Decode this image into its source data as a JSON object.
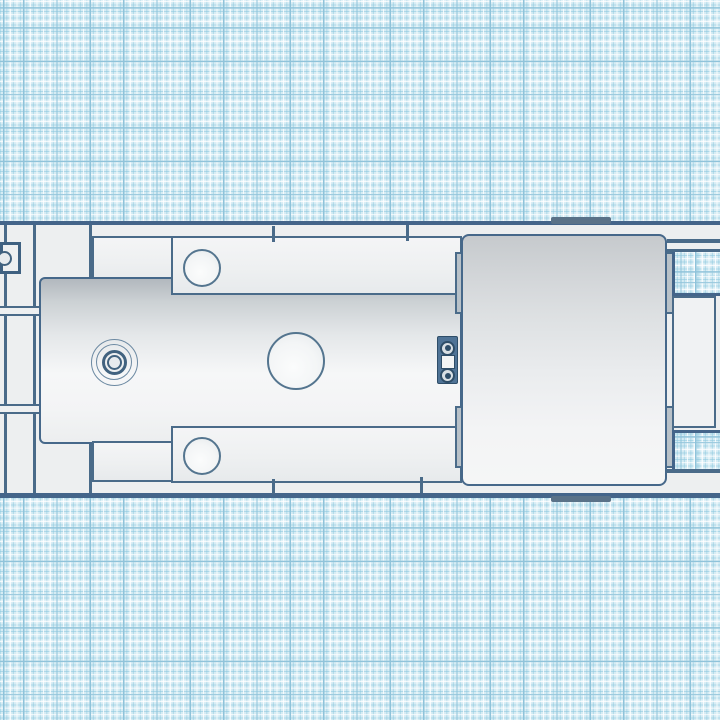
{
  "app": {
    "view": "3d-design-workplane-top-view"
  },
  "colors": {
    "grid_background": "#d6ecf4",
    "grid_major_line": "#8fc3da",
    "grid_minor_blue": "#8cc8de",
    "grid_minor_white": "#ffffff",
    "outline_ink": "#44658a",
    "deck_fill": "#edeff0",
    "panel_fill": "#f0f2f3",
    "body_top_shade": "#b2b8be",
    "cab_top_shade": "#c6cacd",
    "coupler_plate": "#4f7396",
    "ear_fill": "#b8c1c8",
    "tab_fill": "#5a7288"
  },
  "workplane": {
    "grid_major_px": 33.333,
    "grid_minor_px": 6.667,
    "grid_offset_x": 23,
    "grid_offset_y": 8.67
  },
  "scene": {
    "parts": [
      {
        "name": "deck-base",
        "type": "rect",
        "cls": "deck",
        "x": 0,
        "y": 221,
        "w": 720,
        "h": 277,
        "interactable": true
      },
      {
        "name": "deck-top-edge",
        "type": "rect",
        "cls": "ink",
        "x": 0,
        "y": 221,
        "w": 720,
        "h": 4,
        "interactable": false
      },
      {
        "name": "deck-bottom-edge",
        "type": "rect",
        "cls": "ink",
        "x": 0,
        "y": 493,
        "w": 720,
        "h": 5,
        "interactable": false
      },
      {
        "name": "left-seam-line",
        "type": "rect",
        "cls": "ink-thin",
        "x": 4,
        "y": 225,
        "w": 2.5,
        "h": 268,
        "interactable": false
      },
      {
        "name": "left-column-line",
        "type": "rect",
        "cls": "ink-thin",
        "x": 33,
        "y": 225,
        "w": 3,
        "h": 268,
        "interactable": false
      },
      {
        "name": "left-crossbar-upper",
        "type": "rect",
        "cls": "strip",
        "x": 0,
        "y": 306,
        "w": 41,
        "h": 10,
        "interactable": true
      },
      {
        "name": "left-crossbar-lower",
        "type": "rect",
        "cls": "strip",
        "x": 0,
        "y": 404,
        "w": 41,
        "h": 10,
        "interactable": true
      },
      {
        "name": "front-post-line-top",
        "type": "rect",
        "cls": "ink-thin",
        "x": 89,
        "y": 225,
        "w": 3,
        "h": 56,
        "interactable": false
      },
      {
        "name": "front-post-line-bottom",
        "type": "rect",
        "cls": "ink-thin",
        "x": 89,
        "y": 441,
        "w": 3,
        "h": 52,
        "interactable": false
      },
      {
        "name": "front-rail-top",
        "type": "rect",
        "cls": "panel",
        "x": 92,
        "y": 236,
        "w": 82,
        "h": 48,
        "interactable": true
      },
      {
        "name": "engine-body",
        "type": "rect",
        "cls": "body-grad",
        "x": 39,
        "y": 277,
        "w": 423,
        "h": 167,
        "interactable": true
      },
      {
        "name": "side-rail-top",
        "type": "rect",
        "cls": "panel",
        "x": 171,
        "y": 236,
        "w": 291,
        "h": 59,
        "interactable": true
      },
      {
        "name": "side-rail-top-hole",
        "type": "circle",
        "cls": "hole",
        "cx": 202,
        "cy": 268,
        "r": 19,
        "interactable": true
      },
      {
        "name": "front-rail-bottom",
        "type": "rect",
        "cls": "panel",
        "x": 92,
        "y": 441,
        "w": 82,
        "h": 41,
        "interactable": true
      },
      {
        "name": "side-rail-bottom",
        "type": "rect",
        "cls": "panel",
        "x": 171,
        "y": 426,
        "w": 291,
        "h": 57,
        "interactable": true
      },
      {
        "name": "side-rail-bottom-hole",
        "type": "circle",
        "cls": "hole",
        "cx": 202,
        "cy": 456,
        "r": 19,
        "interactable": true
      },
      {
        "name": "dome-ring-outer",
        "type": "circle",
        "cls": "ring1",
        "cx": 114,
        "cy": 362,
        "r": 23.5,
        "interactable": true
      },
      {
        "name": "dome-ring-middle",
        "type": "circle",
        "cls": "ring1",
        "cx": 114,
        "cy": 362,
        "r": 18,
        "interactable": true
      },
      {
        "name": "dome-ring-inner",
        "type": "circle",
        "cls": "ring2",
        "cx": 114,
        "cy": 362,
        "r": 12.5,
        "interactable": true
      },
      {
        "name": "dome-hub",
        "type": "circle",
        "cls": "ring3",
        "cx": 114,
        "cy": 362,
        "r": 7.5,
        "interactable": true
      },
      {
        "name": "body-round-hole",
        "type": "circle",
        "cls": "hole",
        "cx": 296,
        "cy": 361,
        "r": 29,
        "interactable": true
      },
      {
        "name": "deck-post-top-a",
        "type": "rect",
        "cls": "ink-thin",
        "x": 272,
        "y": 226,
        "w": 3,
        "h": 16,
        "interactable": false
      },
      {
        "name": "deck-post-top-b",
        "type": "rect",
        "cls": "ink-thin",
        "x": 406,
        "y": 225,
        "w": 3,
        "h": 16,
        "interactable": false
      },
      {
        "name": "deck-post-bottom-a",
        "type": "rect",
        "cls": "ink-thin",
        "x": 272,
        "y": 479,
        "w": 3,
        "h": 15,
        "interactable": false
      },
      {
        "name": "deck-post-bottom-b",
        "type": "rect",
        "cls": "ink-thin",
        "x": 420,
        "y": 477,
        "w": 3,
        "h": 16,
        "interactable": false
      },
      {
        "name": "coupler-plate",
        "type": "rect",
        "cls": "plate",
        "x": 437,
        "y": 336,
        "w": 21,
        "h": 48,
        "interactable": true
      },
      {
        "name": "coupler-window",
        "type": "rect",
        "cls": "window",
        "x": 440.5,
        "y": 355,
        "w": 14,
        "h": 14,
        "interactable": true
      },
      {
        "name": "coupler-bolt-top",
        "type": "circle",
        "cls": "bolt",
        "cx": 447.5,
        "cy": 348,
        "r": 7.5,
        "interactable": true
      },
      {
        "name": "coupler-bolt-top-dot",
        "type": "circle",
        "cls": "boltdot",
        "cx": 447.5,
        "cy": 348,
        "r": 3,
        "interactable": false
      },
      {
        "name": "coupler-bolt-bottom",
        "type": "circle",
        "cls": "bolt",
        "cx": 447.5,
        "cy": 375.5,
        "r": 7.5,
        "interactable": true
      },
      {
        "name": "coupler-bolt-bottom-dot",
        "type": "circle",
        "cls": "boltdot",
        "cx": 447.5,
        "cy": 375.5,
        "r": 3,
        "interactable": false
      },
      {
        "name": "cab-ear-left-top",
        "type": "rect",
        "cls": "ear",
        "x": 454.5,
        "y": 252,
        "w": 8.5,
        "h": 62,
        "interactable": true
      },
      {
        "name": "cab-ear-left-bottom",
        "type": "rect",
        "cls": "ear",
        "x": 454.5,
        "y": 406,
        "w": 8.5,
        "h": 62,
        "interactable": true
      },
      {
        "name": "cab-ear-right-top",
        "type": "rect",
        "cls": "ear",
        "x": 665,
        "y": 252,
        "w": 9,
        "h": 62,
        "interactable": true
      },
      {
        "name": "cab-ear-right-bottom",
        "type": "rect",
        "cls": "ear",
        "x": 665,
        "y": 406,
        "w": 9,
        "h": 62,
        "interactable": true
      },
      {
        "name": "cab-block",
        "type": "rect",
        "cls": "cab-grad",
        "x": 461,
        "y": 234,
        "w": 206,
        "h": 252,
        "interactable": true
      },
      {
        "name": "rear-grid-gap-upper",
        "type": "rect",
        "cls": "gg-upper",
        "x": 672,
        "y": 252,
        "w": 48,
        "h": 44,
        "grid": true,
        "interactable": false
      },
      {
        "name": "rear-grid-gap-lower",
        "type": "rect",
        "cls": "gg-lower",
        "x": 672,
        "y": 430,
        "w": 48,
        "h": 39,
        "grid": true,
        "interactable": false
      },
      {
        "name": "rear-rail-inner-line",
        "type": "rect",
        "cls": "ink-thin",
        "x": 667,
        "y": 239,
        "w": 53,
        "h": 3.5,
        "interactable": false
      },
      {
        "name": "rear-rail-top-edge",
        "type": "rect",
        "cls": "ink-thin",
        "x": 667,
        "y": 249,
        "w": 53,
        "h": 3,
        "interactable": false
      },
      {
        "name": "rear-rail-bottom-edge",
        "type": "rect",
        "cls": "ink-thin",
        "x": 666,
        "y": 469,
        "w": 54,
        "h": 4,
        "interactable": false
      },
      {
        "name": "rear-frame",
        "type": "rect",
        "cls": "panel-plain",
        "x": 672,
        "y": 296,
        "w": 44,
        "h": 132,
        "interactable": true
      },
      {
        "name": "hitch-box",
        "type": "rect",
        "cls": "hitch",
        "x": 0,
        "y": 242,
        "w": 21,
        "h": 32,
        "interactable": true
      },
      {
        "name": "hitch-ring",
        "type": "circle",
        "cls": "ring3",
        "cx": 4.5,
        "cy": 258,
        "r": 7.5,
        "interactable": true
      },
      {
        "name": "handle-tab-top",
        "type": "rect",
        "cls": "tab",
        "x": 551,
        "y": 217,
        "w": 60,
        "h": 6.5,
        "interactable": true
      },
      {
        "name": "handle-tab-bottom",
        "type": "rect",
        "cls": "tab",
        "x": 551,
        "y": 495.5,
        "w": 60,
        "h": 6.5,
        "interactable": true
      }
    ]
  }
}
